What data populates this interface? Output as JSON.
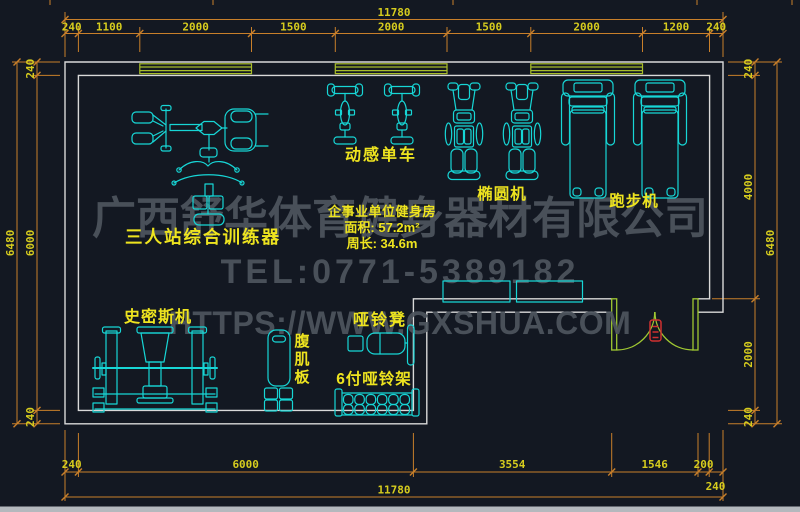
{
  "watermark": {
    "company": "广西舒华体育健身器材有限公司",
    "tel": "TEL:0771-5389182",
    "url": "HTTPS://WWW.GXSHUA.COM"
  },
  "room_info": {
    "name": "企事业单位健身房",
    "area": "面积: 57.2m²",
    "perimeter": "周长: 34.6m"
  },
  "labels": {
    "trainer": "三人站综合训练器",
    "spin_bike": "动感单车",
    "elliptical": "椭圆机",
    "treadmill": "跑步机",
    "smith": "史密斯机",
    "ab_board": [
      "腹",
      "肌",
      "板"
    ],
    "dumbbell_bench": "哑铃凳",
    "dumbbell_rack": "6付哑铃架"
  },
  "dims": {
    "top": {
      "overall": "11780",
      "segments": [
        "240",
        "1100",
        "2000",
        "1500",
        "2000",
        "1500",
        "2000",
        "1200",
        "240"
      ]
    },
    "bottom": {
      "overall": "11780",
      "segments": [
        "240",
        "6000",
        "3554",
        "1546",
        "200",
        "240"
      ]
    },
    "left": {
      "overall": "6480",
      "segments": [
        "240",
        "6000",
        "240"
      ]
    },
    "right": {
      "overall": "6480",
      "segments": [
        "240",
        "4000",
        "2000",
        "240"
      ]
    }
  },
  "colors": {
    "background": "#131822",
    "walls": "#d9d9d9",
    "equipment": "#17d6d6",
    "dimension_lines": "#c87f2a",
    "dimension_text": "#d6cc1e",
    "labels": "#eee41f",
    "windows": "#a9be2a",
    "door": "#a0c832",
    "door_tag": "#d03030",
    "watermark": "#4e555e"
  }
}
